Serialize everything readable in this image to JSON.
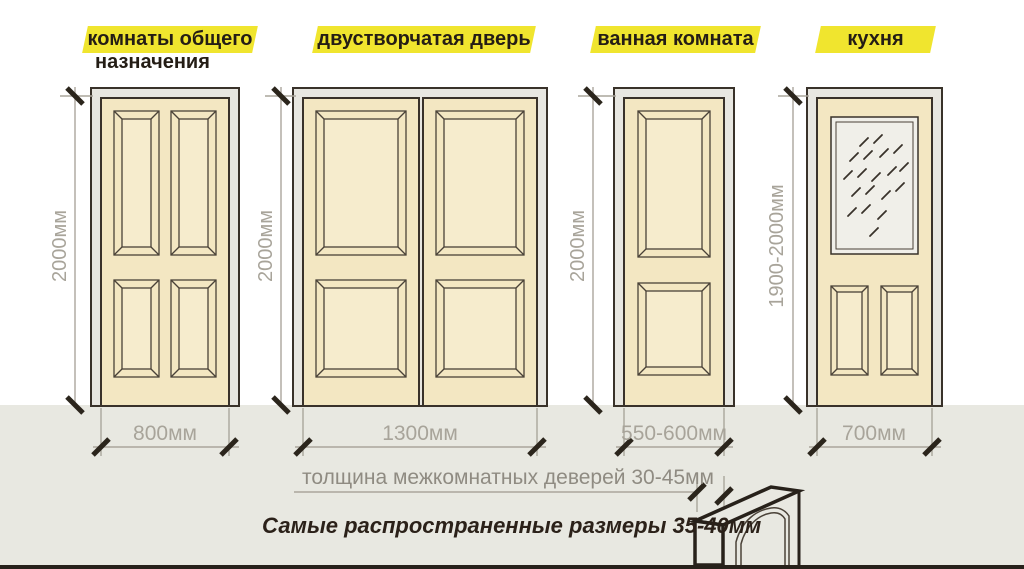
{
  "doors": [
    {
      "name": "комнаты общего назначения",
      "label_line1": "комнаты общего",
      "label_line2": "назначения",
      "height": "2000мм",
      "width": "800мм",
      "style": "four-panel"
    },
    {
      "name": "двустворчатая дверь",
      "label_line1": "двустворчатая дверь",
      "label_line2": "",
      "height": "2000мм",
      "width": "1300мм",
      "style": "double-leaf"
    },
    {
      "name": "ванная комната",
      "label_line1": "ванная комната",
      "label_line2": "",
      "height": "2000мм",
      "width": "550-600мм",
      "style": "two-panel"
    },
    {
      "name": "кухня",
      "label_line1": "кухня",
      "label_line2": "",
      "height": "1900-2000мм",
      "width": "700мм",
      "style": "glass-top"
    }
  ],
  "notes": {
    "thickness": "толщина межкомнатных деверей 30-45мм",
    "common_size": "Самые распространенные размеры 35-40мм"
  },
  "colors": {
    "highlight_yellow": "#f0e52e",
    "label_text": "#241d15",
    "wood_fill": "#f3e7c2",
    "wood_panel_inner": "#f6eccd",
    "frame_fill": "#e8e7e1",
    "outline_dark": "#39322a",
    "dimension_gray": "#a8a49a",
    "tick_dark": "#2b251c",
    "glass_fill": "#f0efe9",
    "floor_fill": "#e8e8e1"
  }
}
